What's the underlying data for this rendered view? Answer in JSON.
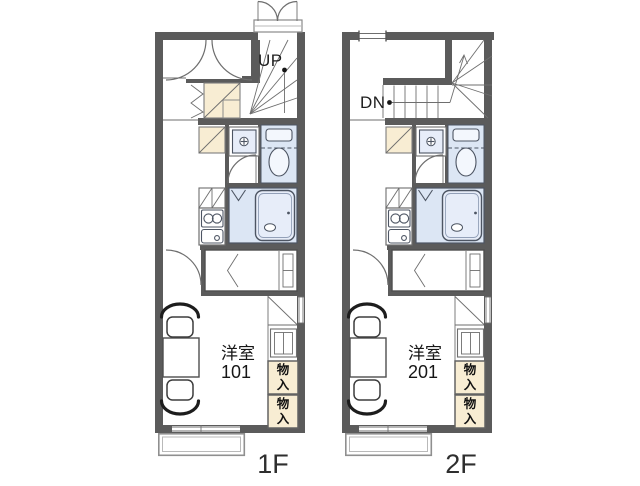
{
  "floors": {
    "f1": {
      "name": "1F",
      "stair_label": "UP",
      "room_label": "洋室",
      "room_number": "101"
    },
    "f2": {
      "name": "2F",
      "stair_label": "DN",
      "room_label": "洋室",
      "room_number": "201"
    }
  },
  "storage_label": "物入",
  "colors": {
    "wall": "#5b5b5b",
    "line": "#6e6e6e",
    "fixture_fill": "#dce6f4",
    "fixture_fill_light": "#e7edf9",
    "fixture_stroke": "#4d5563",
    "beige": "#f8edd3",
    "balcony_line": "#8f8f8f",
    "text": "#1c1c1c",
    "floor_label": "#2e2e2e"
  }
}
